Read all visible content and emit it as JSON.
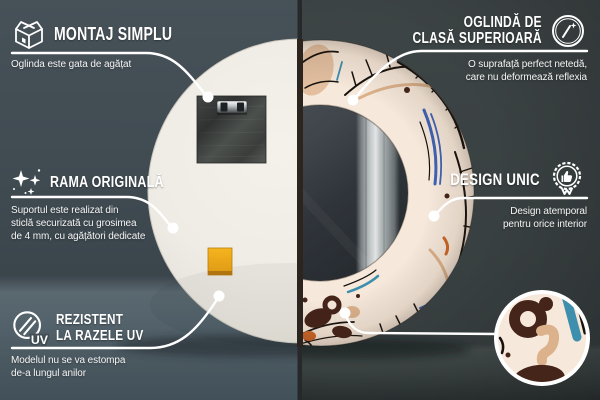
{
  "callouts": {
    "montaj": {
      "icon": "box-icon",
      "title": "MONTAJ SIMPLU",
      "subtitle": "Oglinda este gata de agățat"
    },
    "premium": {
      "icon": "mirror-shine-icon",
      "title_lines": [
        "OGLINDĂ DE",
        "CLASĂ SUPERIOARĂ"
      ],
      "subtitle_lines": [
        "O suprafață perfect netedă,",
        "care nu deformează reflexia"
      ]
    },
    "rama": {
      "icon": "sparkles-icon",
      "title": "RAMA ORIGINALĂ",
      "subtitle_lines": [
        "Suportul este realizat din",
        "sticlă securizată cu grosimea",
        "de 4 mm, cu agățători dedicate"
      ]
    },
    "design": {
      "icon": "award-ribbon-icon",
      "title": "DESIGN UNIC",
      "subtitle_lines": [
        "Design atemporal",
        "pentru orice interior"
      ]
    },
    "uv": {
      "icon": "uv-circle-icon",
      "icon_label": "UV",
      "title_lines": [
        "REZISTENT",
        "LA RAZELE UV"
      ],
      "subtitle_lines": [
        "Modelul nu se va estompa",
        "de-a lungul anilor"
      ]
    }
  },
  "colors": {
    "wall-left": "#414c53",
    "wall-right": "#3a4142",
    "floor-left": "#55636b",
    "floor-right": "#3f4747",
    "text": "#ffffff",
    "mirror-back": "#eeebe4",
    "pattern-cream": "#f6e8da",
    "pattern-black": "#17120e",
    "pattern-blue": "#3f63b5",
    "pattern-teal": "#3e8fae",
    "pattern-brown": "#45241a",
    "pattern-orange": "#cc6629",
    "pattern-tan": "#dcb28c",
    "sticker-yellow": "#eda71c",
    "callout-line": "#ffffff"
  }
}
